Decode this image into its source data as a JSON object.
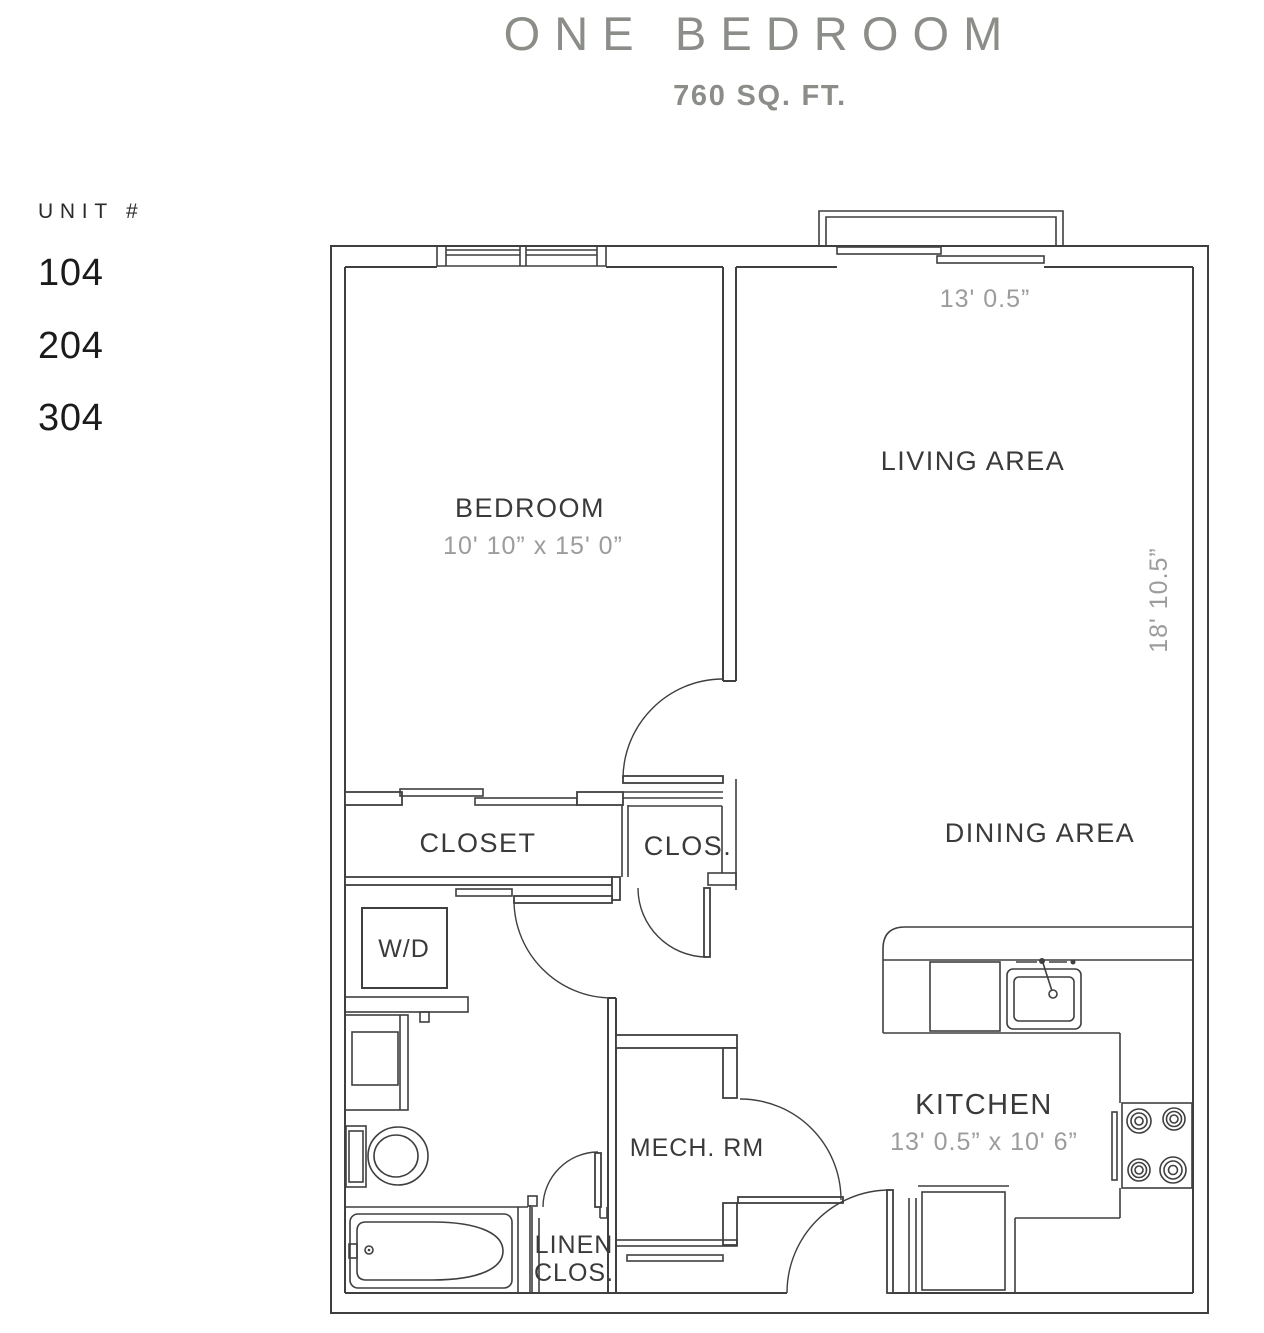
{
  "header": {
    "title": "ONE BEDROOM",
    "subtitle": "760 SQ. FT."
  },
  "units": {
    "heading": "UNIT #",
    "items": [
      "104",
      "204",
      "304"
    ]
  },
  "plan": {
    "labels": {
      "bedroom": "BEDROOM",
      "bedroom_dims": "10' 10” x 15' 0”",
      "living": "LIVING AREA",
      "dining": "DINING AREA",
      "kitchen": "KITCHEN",
      "kitchen_dims": "13' 0.5” x 10' 6”",
      "closet": "CLOSET",
      "clos": "CLOS.",
      "wd": "W/D",
      "mech": "MECH. RM",
      "linen_line1": "LINEN",
      "linen_line2": "CLOS.",
      "dim_top": "13' 0.5”",
      "dim_right": "18' 10.5”"
    },
    "overall": {
      "width_label": "13' 0.5”",
      "height_label": "18' 10.5”",
      "area_label": "760 SQ. FT."
    },
    "fixtures": [
      "double-window",
      "box-window",
      "sliding-glass-door",
      "sliding-closet-doors",
      "washer-dryer",
      "vanity-sink",
      "toilet",
      "bathtub",
      "kitchen-sink",
      "dishwasher",
      "range-stove",
      "refrigerator",
      "door-swings"
    ],
    "colors": {
      "wall_line": "#3f3f3f",
      "room_label": "#3a3a3a",
      "dimension_text": "#9c9c9c",
      "title_text": "#8b8e88",
      "unit_text": "#1b1b1b",
      "background": "#ffffff"
    }
  }
}
